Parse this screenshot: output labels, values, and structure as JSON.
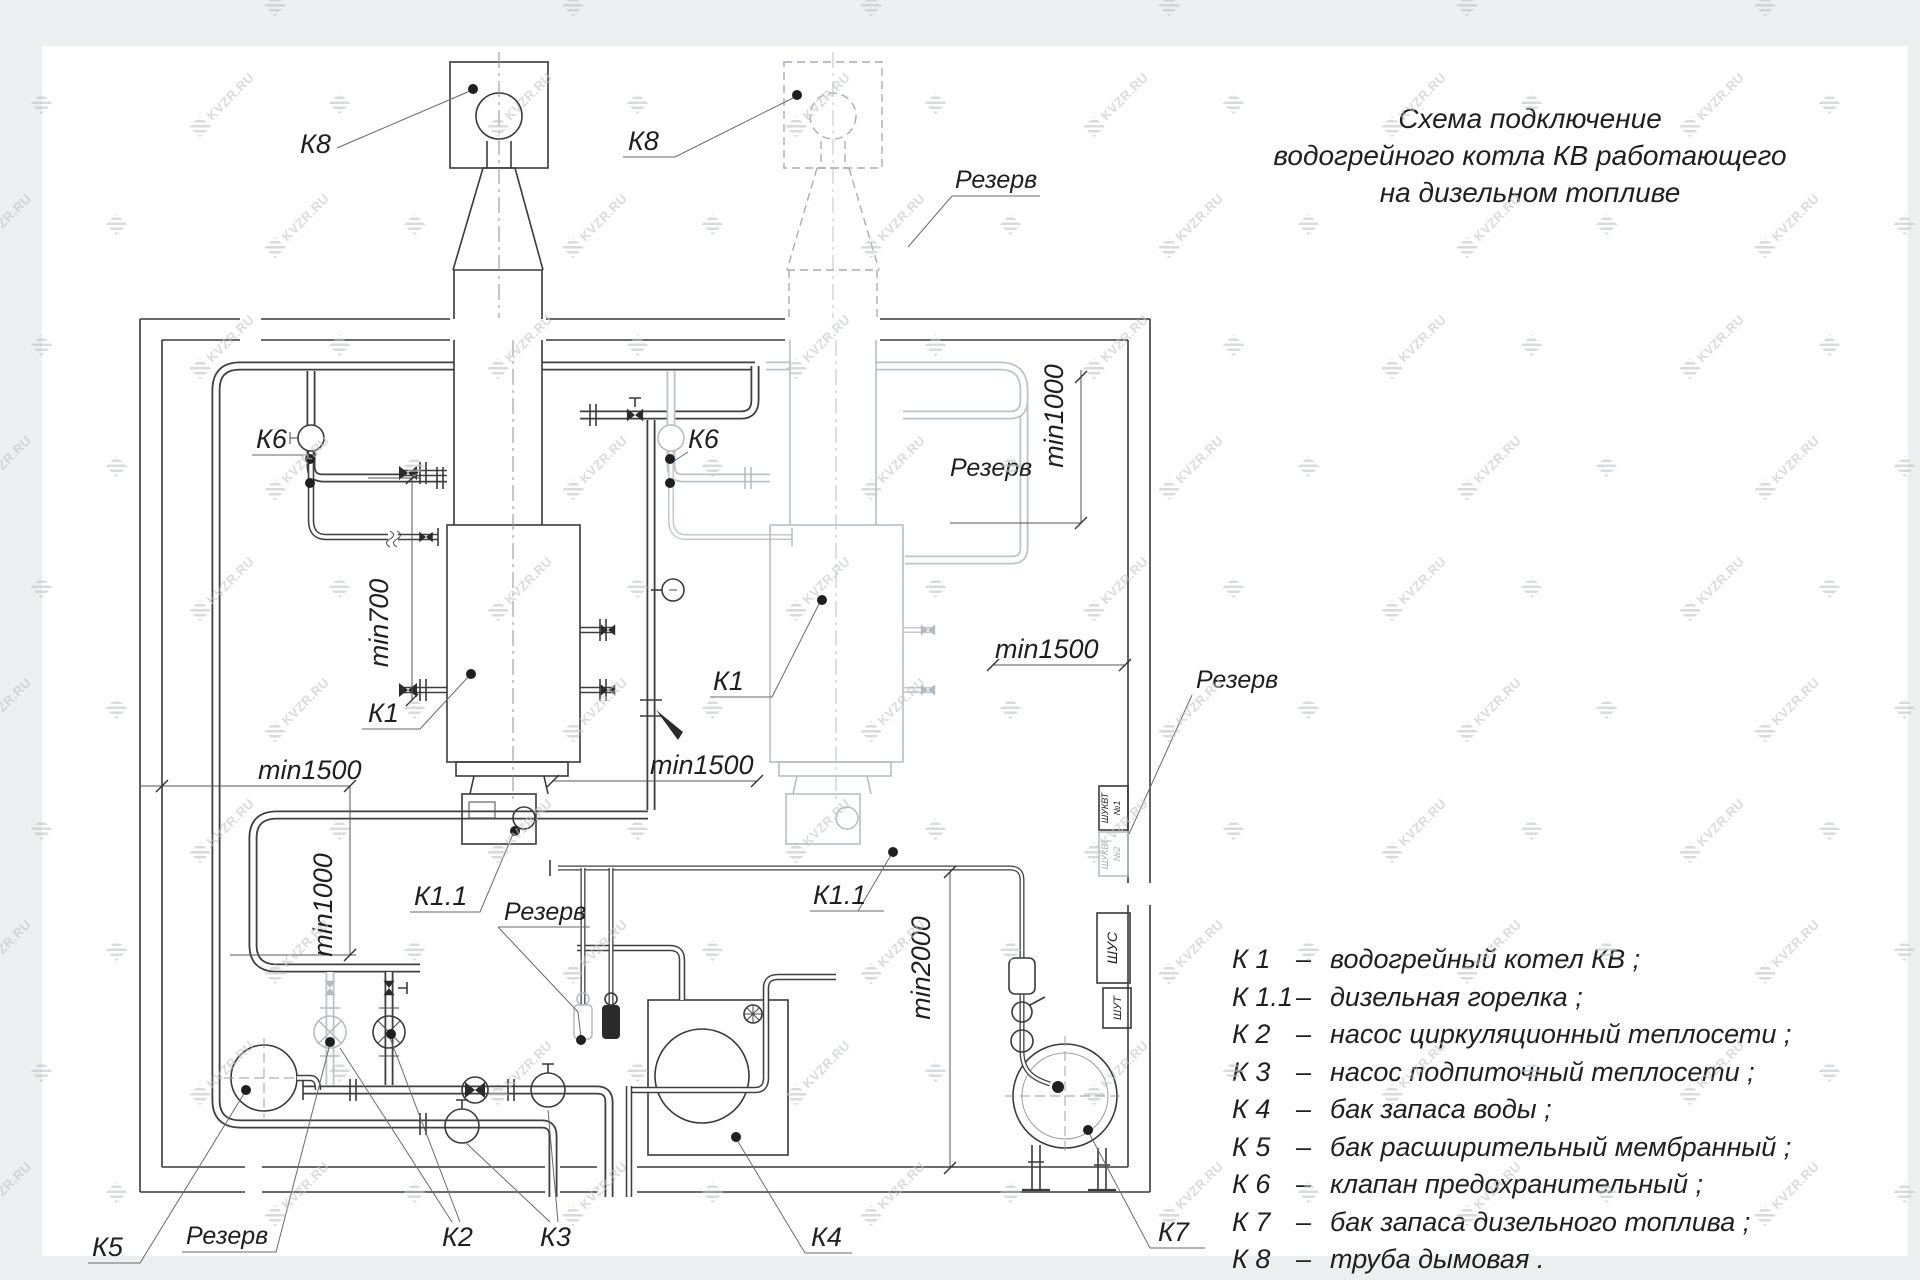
{
  "watermark": {
    "text": "KVZR.RU"
  },
  "title": {
    "lines": [
      "Схема подключение",
      "водогрейного котла КВ работающего",
      "на дизельном топливе"
    ]
  },
  "legend": {
    "items": [
      {
        "key": "К 1",
        "dash": "–",
        "desc": "водогрейный котел КВ ;"
      },
      {
        "key": "К 1.1",
        "dash": "–",
        "desc": "дизельная горелка ;"
      },
      {
        "key": "К 2",
        "dash": "–",
        "desc": "насос циркуляционный теплосети ;"
      },
      {
        "key": "К 3",
        "dash": "–",
        "desc": "насос подпиточный теплосети ;"
      },
      {
        "key": "К 4",
        "dash": "–",
        "desc": "бак запаса воды ;"
      },
      {
        "key": "К 5",
        "dash": "–",
        "desc": "бак расширительный мембранный ;"
      },
      {
        "key": "К 6",
        "dash": "–",
        "desc": "клапан предохранительный ;"
      },
      {
        "key": "К 7",
        "dash": "–",
        "desc": "бак запаса дизельного топлива ;"
      },
      {
        "key": "К 8",
        "dash": "–",
        "desc": "труба дымовая ."
      }
    ]
  },
  "diagram": {
    "labels": {
      "k8_1": "К8",
      "k8_2": "К8",
      "k6_1": "К6",
      "k6_2": "К6",
      "k1_1": "К1",
      "k1_2": "К1",
      "k11_1": "К1.1",
      "k11_2": "К1.1",
      "k2": "К2",
      "k3": "К3",
      "k4": "К4",
      "k5": "К5",
      "k7": "К7",
      "rezerv_chimney": "Резерв",
      "rezerv_boiler": "Резерв",
      "rezerv_cabinet": "Резерв",
      "rezerv_fuelunit": "Резерв",
      "rezerv_pump": "Резерв",
      "min700": "min700",
      "min1000_left": "min1000",
      "min1000_right": "min1000",
      "min1500_left": "min1500",
      "min1500_mid": "min1500",
      "min1500_right": "min1500",
      "min2000": "min2000"
    },
    "cabinets": {
      "c1_line1": "ШУКВТ",
      "c1_line2": "№1",
      "c2_line1": "ШУКВТ",
      "c2_line2": "№2",
      "c3": "ШУС",
      "c4": "ШУТ"
    },
    "colors": {
      "line": "#3a3a3a",
      "ghost": "#bdc3c8",
      "dot": "#1f1f1f",
      "watermark": "#c0c4c8"
    }
  }
}
